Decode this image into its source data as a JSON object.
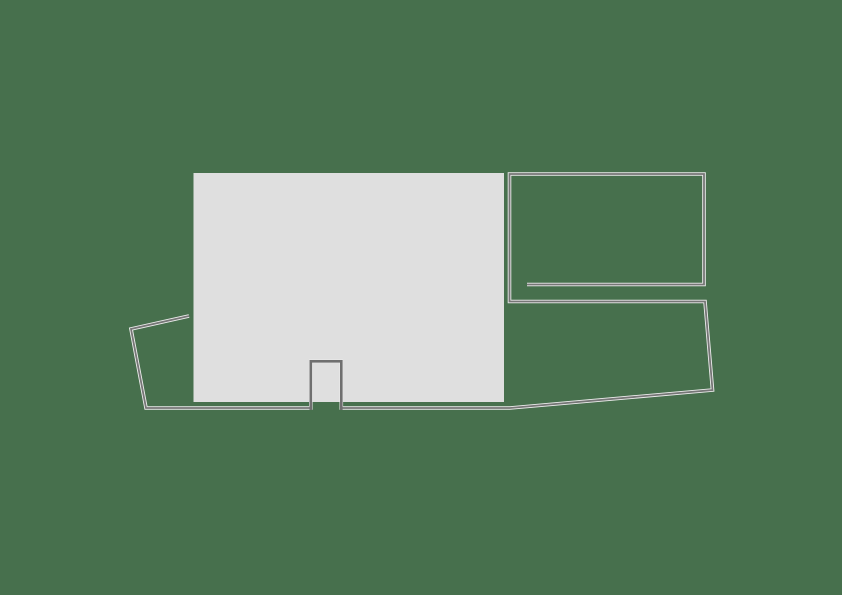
{
  "canvas": {
    "width": 842,
    "height": 595,
    "background": "#47704d"
  },
  "colors": {
    "floor_fill": "#dfdfdf",
    "wall_stroke": "#767676",
    "wall_highlight": "#ececec",
    "notch_stroke": "#6f6f6f"
  },
  "shapes": {
    "floor": {
      "x": 193.5,
      "y": 173,
      "width": 310.5,
      "height": 229
    },
    "boundary": {
      "points": [
        [
          189,
          316
        ],
        [
          131,
          329
        ],
        [
          146,
          408
        ],
        [
          310.8,
          408
        ],
        [
          310.8,
          361.3
        ],
        [
          341.3,
          361.3
        ],
        [
          341.3,
          408
        ],
        [
          510,
          408
        ],
        [
          712.5,
          390
        ],
        [
          705,
          301.5
        ],
        [
          509.5,
          301.5
        ],
        [
          509.5,
          174
        ],
        [
          704,
          174
        ],
        [
          704,
          284.5
        ],
        [
          527,
          284.5
        ]
      ]
    },
    "doorway": {
      "points": [
        [
          310.8,
          410
        ],
        [
          310.8,
          361.3
        ],
        [
          341.3,
          361.3
        ],
        [
          341.3,
          410
        ]
      ]
    }
  }
}
